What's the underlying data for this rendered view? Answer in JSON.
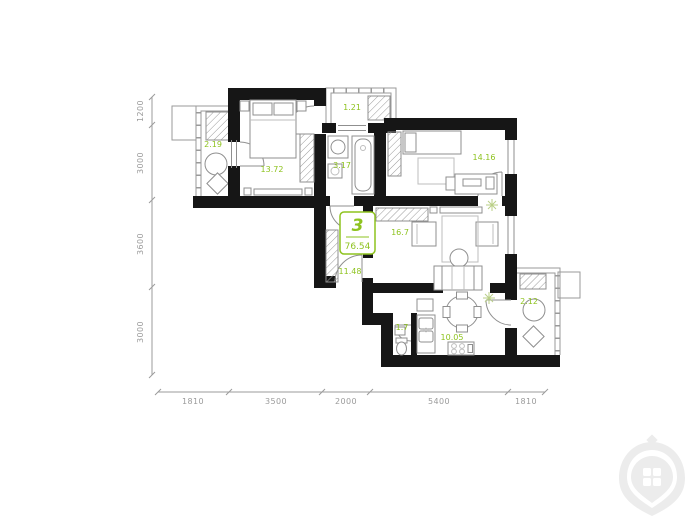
{
  "plan": {
    "badge": {
      "rooms": "3",
      "area": "76.54"
    },
    "rooms": {
      "balcony_left": "2.19",
      "bedroom_left": "13.72",
      "balcony_top": "1.21",
      "bathroom": "3.17",
      "bedroom_right": "14.16",
      "living_room": "16.7",
      "hallway": "11.48",
      "wc": "1.7",
      "kitchen": "10.05",
      "balcony_right": "2.12"
    },
    "dims": {
      "left": [
        "1200",
        "3000",
        "3600",
        "3000"
      ],
      "bottom": [
        "1810",
        "3500",
        "2000",
        "5400",
        "1810"
      ]
    },
    "colors": {
      "accent_green": "#8ec31f",
      "wall_black": "#161616",
      "line_gray": "#8f8f8f",
      "dim_gray": "#9b9b9b",
      "watermark_gray": "#ececec"
    },
    "icons": {
      "air_conditioner": "snowflake-icon",
      "watermark": "window-pin-icon"
    }
  }
}
